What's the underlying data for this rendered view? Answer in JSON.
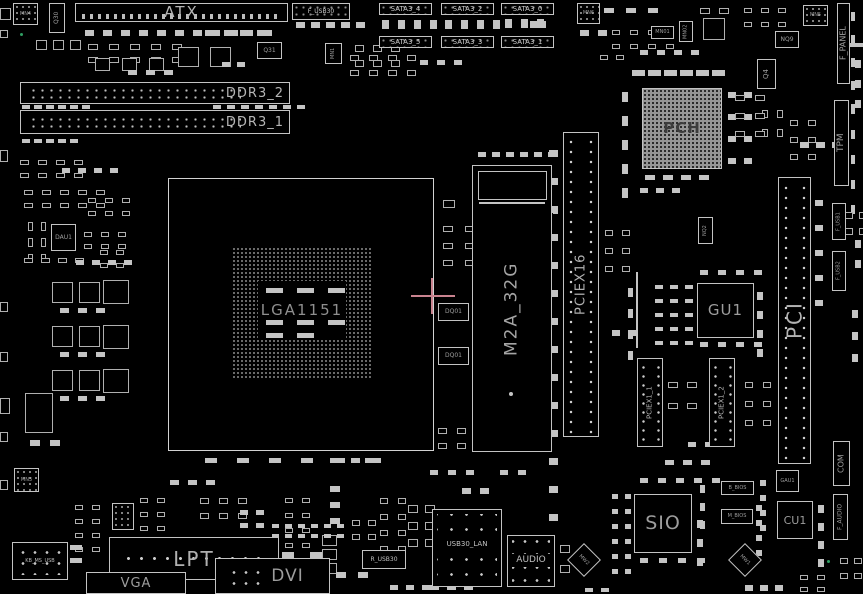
{
  "labels": {
    "atx": "ATX",
    "mn4": "MN4",
    "q30": "Q30",
    "q31": "Q31",
    "ddr3_2": "DDR3_2",
    "ddr3_1": "DDR3_1",
    "f_usb30": "F_USB30",
    "mn1": "MN1",
    "sata3_4": "SATA3_4",
    "sata3_2": "SATA3_2",
    "sata3_0": "SATA3_0",
    "sata3_5": "SATA3_5",
    "sata3_3": "SATA3_3",
    "sata3_1": "SATA3_1",
    "mn6": "MN6",
    "mn01": "MN01",
    "mn02": "MN02",
    "nq9": "NQ9",
    "mn5": "MN5",
    "f_panel": "F_PANEL",
    "pch": "PCH",
    "q4": "Q4",
    "tpm": "TPM",
    "pciex16": "PCIEX16",
    "m2a_32g": "M2A_32G",
    "pci": "PCI",
    "f_usb1": "F_USB1",
    "f_usb2": "F_USB2",
    "nq2": "NQ2",
    "gu1": "GU1",
    "pciex1_1": "PCIEX1_1",
    "pciex1_2": "PCIEX1_2",
    "lga1151": "LGA1151",
    "dq01_a": "DQ01",
    "dq01_b": "DQ01",
    "dau1": "DAU1",
    "mn3": "MN3",
    "kb_ms_usb": "KB_MS_USB",
    "lpt": "LPT",
    "vga": "VGA",
    "dvi": "DVI",
    "r_usb30": "R_USB30",
    "usb30_lan": "USB30_LAN",
    "audio": "AUDIO",
    "sio": "SIO",
    "b_bios": "B_BIOS",
    "m_bios": "M_BIOS",
    "gau1": "GAU1",
    "cu1": "CU1",
    "com": "COM",
    "f_audio": "F_AUDIO",
    "mw1": "MW1",
    "mw2": "MW2"
  },
  "colors": {
    "background": "#000000",
    "outline": "#c3c3c3",
    "label_text": "#9d9d9d",
    "crosshair": "#c9838f",
    "led_green": "#2f9e62"
  }
}
